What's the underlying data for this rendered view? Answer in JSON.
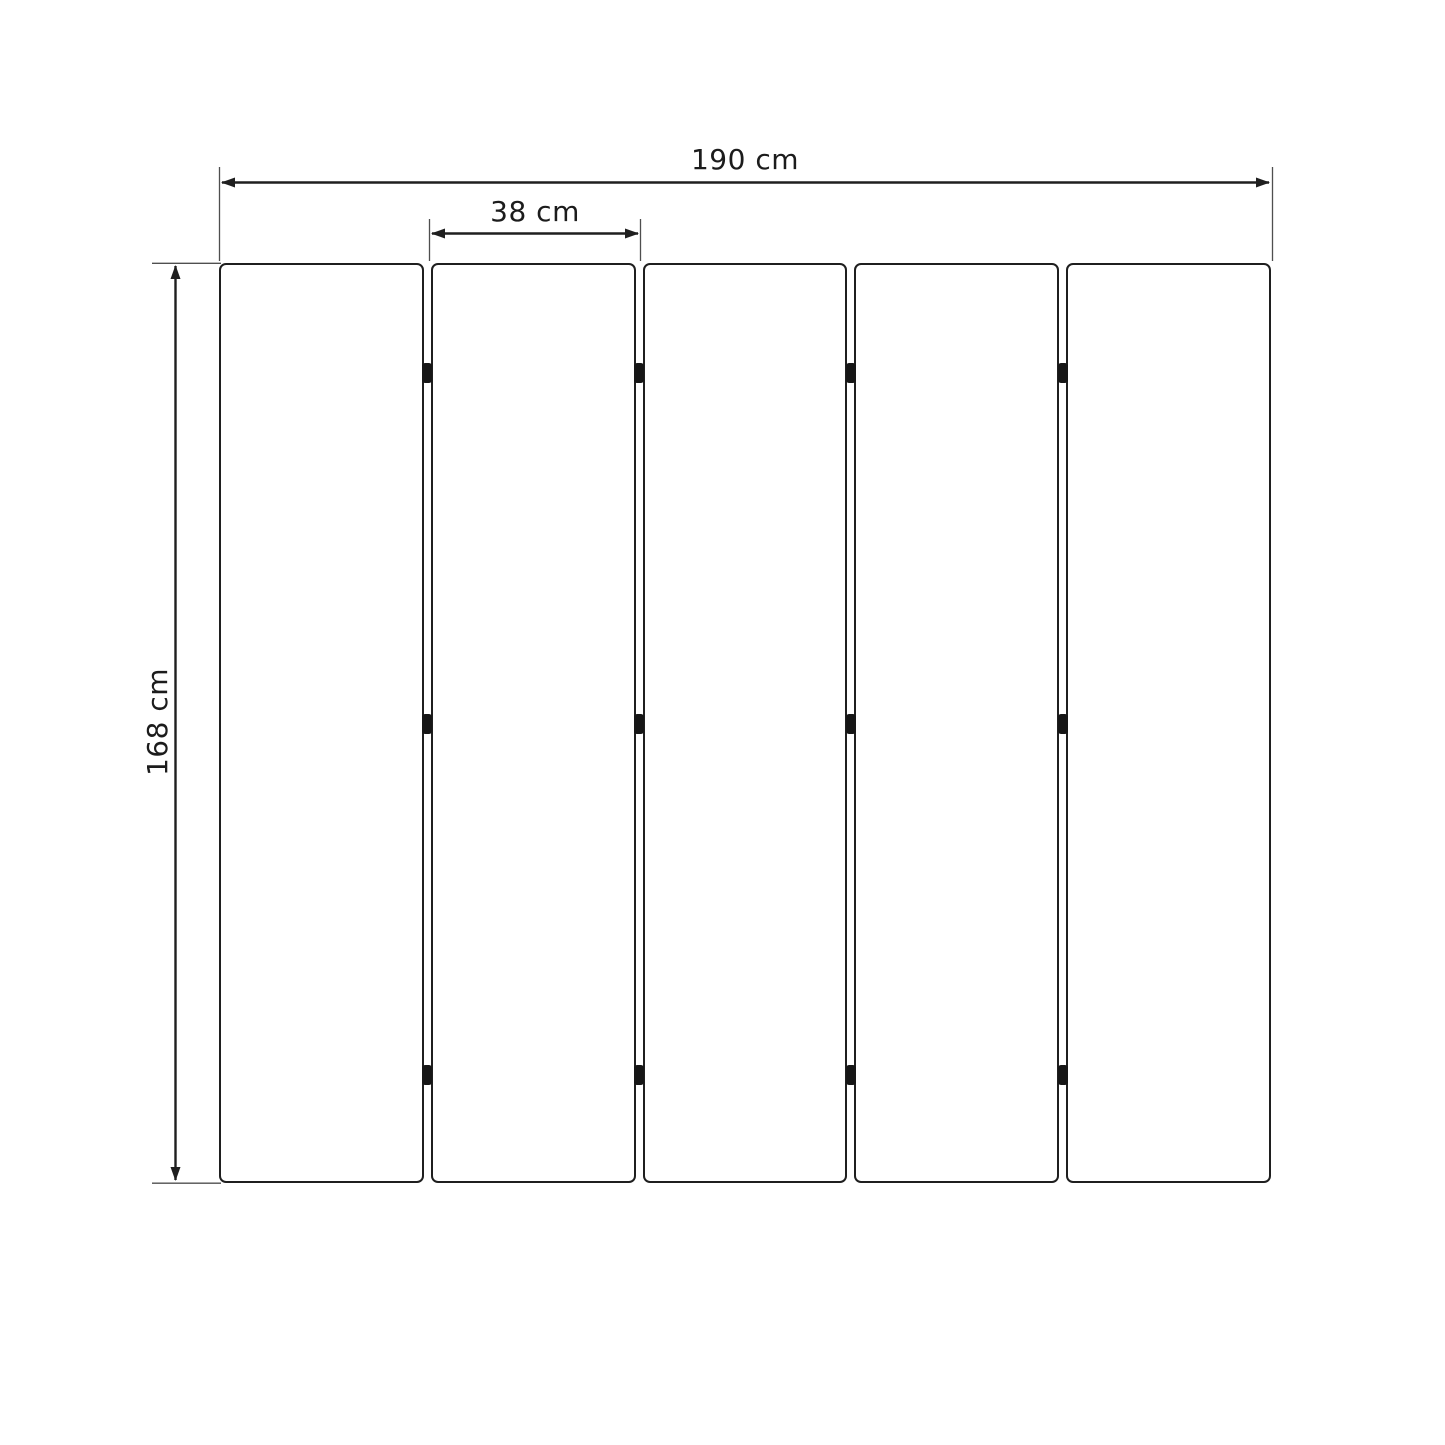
{
  "diagram": {
    "type": "dimension-drawing",
    "labels": {
      "total_width": "190 cm",
      "panel_width": "38 cm",
      "height": "168 cm"
    },
    "panel_count": 5,
    "hinge_rows_per_gap": 3,
    "colors": {
      "line": "#1f1f1f",
      "extension_line": "#4f4f4f",
      "hinge": "#161616",
      "background": "#ffffff",
      "text": "#1c1c1c"
    }
  }
}
